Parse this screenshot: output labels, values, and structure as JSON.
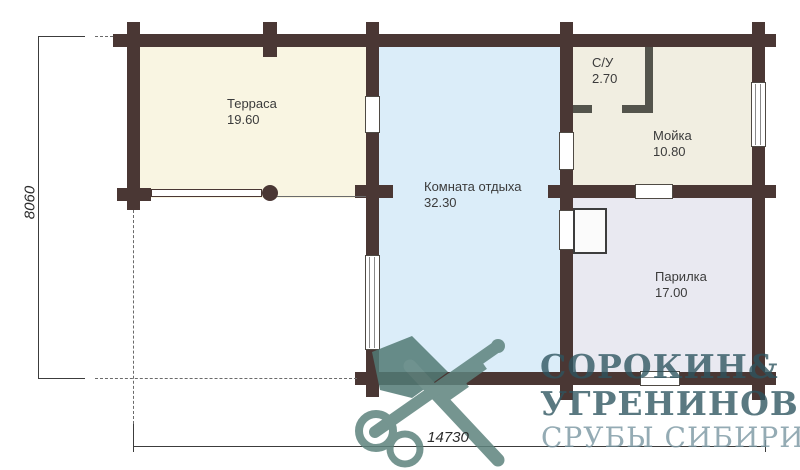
{
  "plan_title": "Floor plan of log bathhouse",
  "rooms": {
    "terrace": {
      "name": "Терраса",
      "area": "19.60"
    },
    "lounge": {
      "name": "Комната отдыха",
      "area": "32.30"
    },
    "wc": {
      "name": "С/У",
      "area": "2.70"
    },
    "washroom": {
      "name": "Мойка",
      "area": "10.80"
    },
    "steam": {
      "name": "Парилка",
      "area": "17.00"
    }
  },
  "dimensions": {
    "height_mm": "8060",
    "width_mm": "14730"
  },
  "watermark": {
    "name1": "СОРОКИН",
    "ampersand": "&",
    "name2": "УГРЕНИНОВ",
    "tagline": "СРУБЫ СИБИРИ",
    "emblem_icon": "crossed-axe-and-key-with-key-rings-icon"
  },
  "colors": {
    "wall": "#4a3734",
    "terrace_fill": "#f9f5e2",
    "lounge_fill": "#dbedf9",
    "washroom_fill": "#f1eee1",
    "steam_fill": "#e9e9f1",
    "partition": "#54544c",
    "watermark_dark": "#2c545e",
    "watermark_light": "#7a97a1",
    "emblem_teal": "#5d837d"
  }
}
